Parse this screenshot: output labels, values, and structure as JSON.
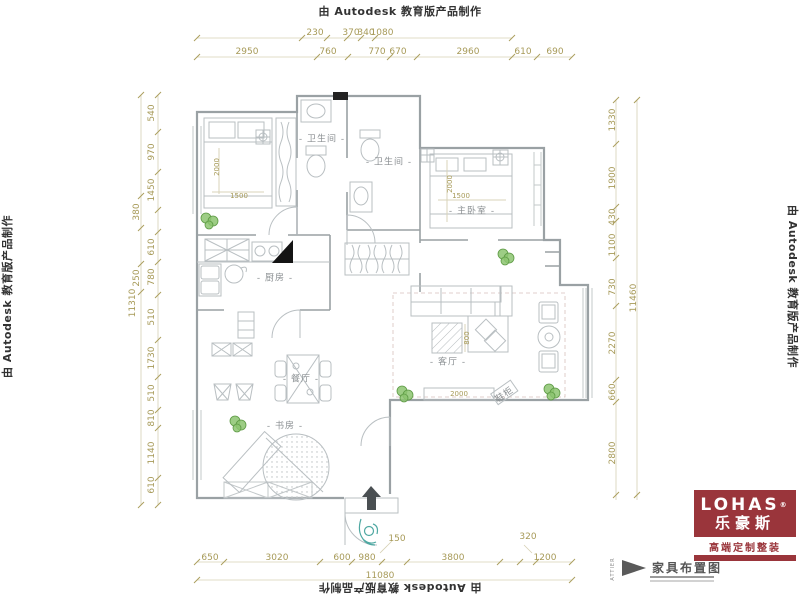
{
  "border": {
    "autodesk_note": "由 Autodesk 教育版产品制作"
  },
  "logo": {
    "brand": "LOHAS",
    "registered": "®",
    "brand_cn": "乐豪斯",
    "tagline": "高端定制整装",
    "brand_color": "#9a353b"
  },
  "title_block": {
    "drawing_title": "家具布置图",
    "side_text": "ATTIER"
  },
  "colors": {
    "dimension_text": "#a79a58",
    "wall_line": "#9aa1a4",
    "plant_green": "#6aaa50",
    "accent_teal": "#4fa8a2"
  },
  "rooms": {
    "labels": [
      {
        "name": "room-label-bathroom-1",
        "text": "- 卫生间 -",
        "x": 322,
        "y": 138
      },
      {
        "name": "room-label-bathroom-2",
        "text": "- 卫生间 -",
        "x": 389,
        "y": 161
      },
      {
        "name": "room-label-master-bedroom",
        "text": "- 主卧室 -",
        "x": 472,
        "y": 210
      },
      {
        "name": "room-label-kitchen",
        "text": "- 厨房 -",
        "x": 275,
        "y": 277
      },
      {
        "name": "room-label-living-room",
        "text": "- 客厅 -",
        "x": 448,
        "y": 361
      },
      {
        "name": "room-label-dining-room",
        "text": "- 餐厅 -",
        "x": 301,
        "y": 378
      },
      {
        "name": "room-label-study",
        "text": "- 书房 -",
        "x": 285,
        "y": 425
      },
      {
        "name": "furniture-label-shoe-cabinet",
        "text": "鞋柜",
        "x": 504,
        "y": 394,
        "rot": -35
      }
    ]
  },
  "furniture": {
    "labels": [
      {
        "name": "dim-bed1-length",
        "text": "2000",
        "x": 217,
        "y": 167,
        "rot": -90
      },
      {
        "name": "dim-bed1-width",
        "text": "1500",
        "x": 239,
        "y": 196,
        "rot": 0
      },
      {
        "name": "dim-bed2-length",
        "text": "2000",
        "x": 450,
        "y": 184,
        "rot": -90
      },
      {
        "name": "dim-bed2-width",
        "text": "1500",
        "x": 461,
        "y": 196,
        "rot": 0
      },
      {
        "name": "dim-coffee-table",
        "text": "800",
        "x": 467,
        "y": 338,
        "rot": -90
      },
      {
        "name": "dim-tv-cabinet",
        "text": "2000",
        "x": 459,
        "y": 394,
        "rot": 0
      }
    ]
  },
  "dimensions": {
    "labels": [
      {
        "text": "230",
        "x": 315,
        "y": 33
      },
      {
        "text": "370",
        "x": 351,
        "y": 33
      },
      {
        "text": "340",
        "x": 366,
        "y": 33
      },
      {
        "text": "1080",
        "x": 382,
        "y": 33
      },
      {
        "text": "2950",
        "x": 247,
        "y": 52
      },
      {
        "text": "760",
        "x": 328,
        "y": 52
      },
      {
        "text": "770",
        "x": 377,
        "y": 52
      },
      {
        "text": "670",
        "x": 398,
        "y": 52
      },
      {
        "text": "2960",
        "x": 468,
        "y": 52
      },
      {
        "text": "610",
        "x": 523,
        "y": 52
      },
      {
        "text": "690",
        "x": 555,
        "y": 52
      },
      {
        "text": "540",
        "x": 152,
        "y": 113,
        "rot": -90
      },
      {
        "text": "970",
        "x": 152,
        "y": 152,
        "rot": -90
      },
      {
        "text": "1450",
        "x": 152,
        "y": 190,
        "rot": -90
      },
      {
        "text": "380",
        "x": 137,
        "y": 212,
        "rot": -90
      },
      {
        "text": "610",
        "x": 152,
        "y": 247,
        "rot": -90
      },
      {
        "text": "780",
        "x": 152,
        "y": 277,
        "rot": -90
      },
      {
        "text": "250",
        "x": 137,
        "y": 278,
        "rot": -90
      },
      {
        "text": "11310",
        "x": 133,
        "y": 303,
        "rot": -90
      },
      {
        "text": "510",
        "x": 152,
        "y": 317,
        "rot": -90
      },
      {
        "text": "1730",
        "x": 152,
        "y": 358,
        "rot": -90
      },
      {
        "text": "510",
        "x": 152,
        "y": 393,
        "rot": -90
      },
      {
        "text": "810",
        "x": 152,
        "y": 418,
        "rot": -90
      },
      {
        "text": "1140",
        "x": 152,
        "y": 453,
        "rot": -90
      },
      {
        "text": "610",
        "x": 152,
        "y": 485,
        "rot": -90
      },
      {
        "text": "1330",
        "x": 613,
        "y": 120,
        "rot": -90
      },
      {
        "text": "1900",
        "x": 613,
        "y": 178,
        "rot": -90
      },
      {
        "text": "430",
        "x": 613,
        "y": 217,
        "rot": -90
      },
      {
        "text": "1100",
        "x": 613,
        "y": 245,
        "rot": -90
      },
      {
        "text": "730",
        "x": 613,
        "y": 287,
        "rot": -90
      },
      {
        "text": "2270",
        "x": 613,
        "y": 343,
        "rot": -90
      },
      {
        "text": "660",
        "x": 613,
        "y": 392,
        "rot": -90
      },
      {
        "text": "2800",
        "x": 613,
        "y": 453,
        "rot": -90
      },
      {
        "text": "11460",
        "x": 634,
        "y": 298,
        "rot": -90
      },
      {
        "text": "650",
        "x": 210,
        "y": 558
      },
      {
        "text": "3020",
        "x": 277,
        "y": 558
      },
      {
        "text": "600",
        "x": 342,
        "y": 558
      },
      {
        "text": "980",
        "x": 367,
        "y": 558
      },
      {
        "text": "150",
        "x": 397,
        "y": 539
      },
      {
        "text": "3800",
        "x": 453,
        "y": 558
      },
      {
        "text": "320",
        "x": 528,
        "y": 537
      },
      {
        "text": "1200",
        "x": 545,
        "y": 558
      },
      {
        "text": "11080",
        "x": 380,
        "y": 576
      }
    ]
  }
}
